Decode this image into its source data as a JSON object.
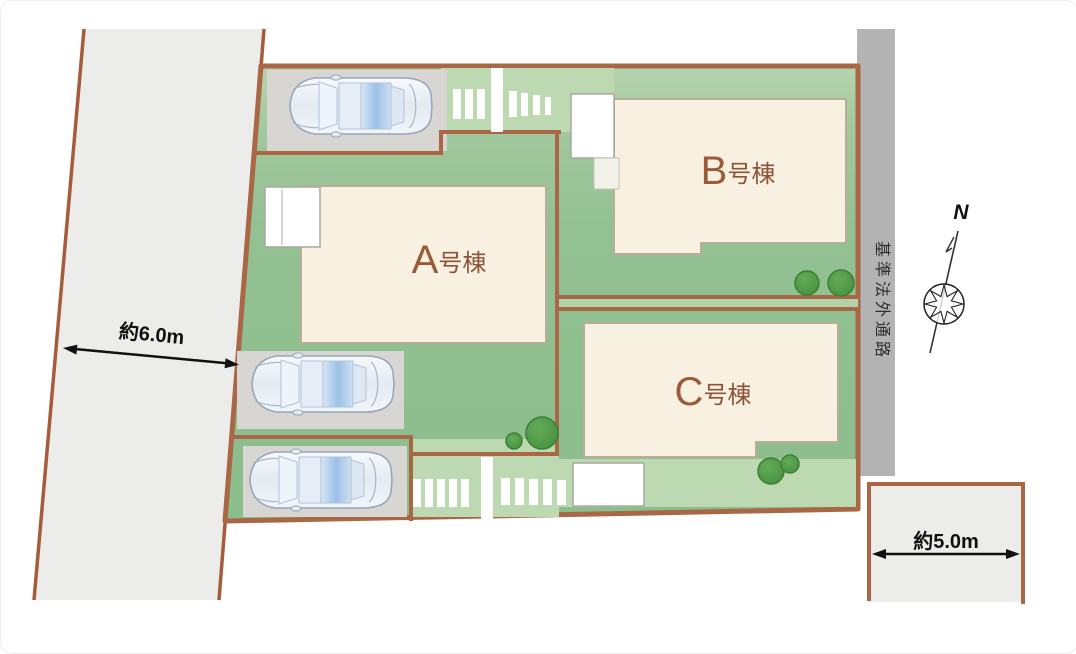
{
  "plan": {
    "buildings": [
      {
        "id": "A",
        "letter": "A",
        "suffix": "号棟",
        "label": "A号棟"
      },
      {
        "id": "B",
        "letter": "B",
        "suffix": "号棟",
        "label": "B号棟"
      },
      {
        "id": "C",
        "letter": "C",
        "suffix": "号棟",
        "label": "C号棟"
      }
    ],
    "dimensions": {
      "left_road_width": "約6.0m",
      "bottom_right_road_width": "約5.0m"
    },
    "passage_label": "基準法外通路",
    "compass": {
      "north_label": "N"
    },
    "icons": [
      "car-top-view-icon",
      "tree-icon",
      "compass-rose-icon"
    ],
    "colors": {
      "boundary_brown": "#a96746",
      "site_green": "#8fbe8e",
      "site_green_light": "#bedbb3",
      "building_fill": "#f8f1e2",
      "building_label": "#9b5a3a",
      "road_fill": "#ececea",
      "passage_fill": "#b3b3b3",
      "parking_fill": "#d7d6d2",
      "tree_green": "#4e9b46",
      "car_glass_blue": "#9cc0e8"
    }
  }
}
